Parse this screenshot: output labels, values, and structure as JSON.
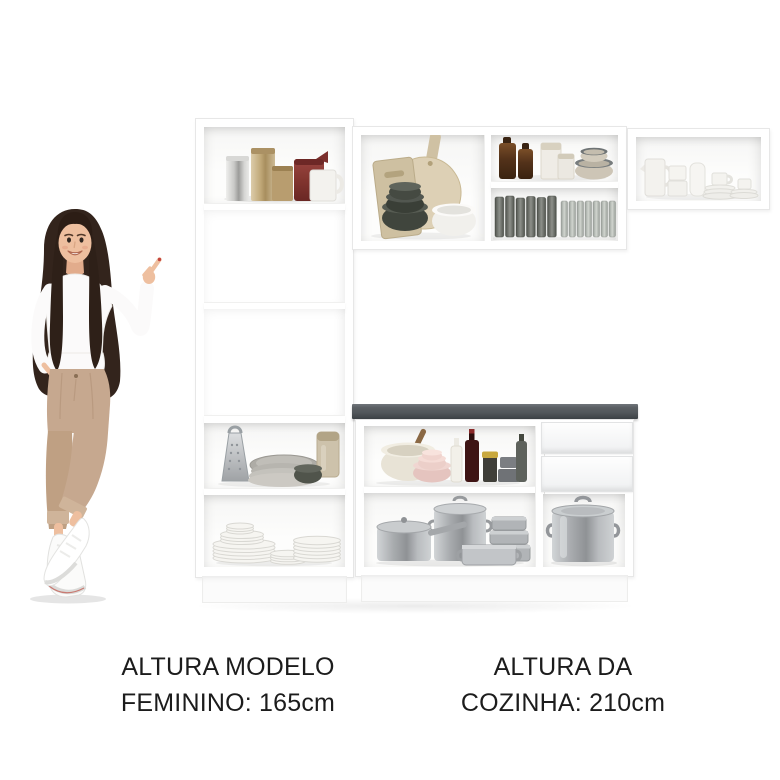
{
  "page": {
    "type": "product-scale-image",
    "background": "#ffffff"
  },
  "captions": {
    "model_height": {
      "line1": "ALTURA MODELO",
      "line2": "FEMININO: 165cm"
    },
    "kitchen_height": {
      "line1": "ALTURA DA",
      "line2": "COZINHA: 210cm"
    }
  },
  "measurements": {
    "model_height": "165cm",
    "kitchen_height": "210cm"
  },
  "model_figure": {
    "description": "woman with long dark hair, white long-sleeve top, beige cropped trousers and white sneakers, pointing up at the kitchen set",
    "pose": "right-hand-pointing-up, left-hand-in-pocket, legs-crossed"
  },
  "kitchen": {
    "tall_cabinet": {
      "compartments": [
        {
          "id": "top-shelf",
          "items": [
            "silver canister",
            "champagne canister",
            "gold tin",
            "dark red jug",
            "white mug"
          ]
        },
        {
          "id": "open-niche-upper",
          "items": []
        },
        {
          "id": "open-niche-lower",
          "items": []
        },
        {
          "id": "middle-shelf",
          "items": [
            "box grater",
            "grey platter stack",
            "storage jar",
            "small dark bowl"
          ]
        },
        {
          "id": "bottom-shelf",
          "items": [
            "pyramid of white plates",
            "small plate stack",
            "plate stack"
          ]
        }
      ]
    },
    "wall_cabinet_middle": {
      "cells": [
        {
          "id": "boards-cell",
          "items": [
            "rectangular cutting board",
            "round cutting board",
            "dark bowl stack",
            "white bowl"
          ]
        },
        {
          "id": "bottles-cell",
          "items": [
            "two amber bottles",
            "two white canisters",
            "beige bowl stack"
          ]
        },
        {
          "id": "glasses-cell",
          "items": [
            "row of dark glasses",
            "row of clear glasses"
          ]
        }
      ]
    },
    "wall_cabinet_right": {
      "cells": [
        {
          "id": "china-cell",
          "items": [
            "white pitcher",
            "white mug stack",
            "white jug",
            "cups and saucers"
          ]
        }
      ]
    },
    "base_cabinet": {
      "countertop": "dark grey",
      "drawers": 2,
      "cells": [
        {
          "id": "prep-shelf",
          "items": [
            "mixing bowl with pestle",
            "pink bowl stack",
            "white bottle",
            "wine bottle",
            "yellow-lid jar",
            "grey canisters",
            "dark bottle"
          ]
        },
        {
          "id": "pots-shelf",
          "items": [
            "saucepan with lid",
            "large lidded pot",
            "stacked pots",
            "low casserole"
          ]
        },
        {
          "id": "stockpot-cell",
          "items": [
            "large stockpot with lid"
          ]
        }
      ]
    }
  },
  "colors": {
    "page_bg": "#ffffff",
    "text": "#1c1c1c",
    "cabinet": "#ffffff",
    "edge": "#e7e7e7",
    "counter_top": "#53585c",
    "hair": "#33241c",
    "hair_dark": "#2c1d15",
    "skin": "#eebf9f",
    "skin_shade": "#e2ac8c",
    "blouse": "#fbfafa",
    "pants": "#c6a88f",
    "pants_dark": "#bfa083",
    "cuff": "#cfb49a",
    "shoe": "#fbfbfa",
    "nail": "#c4453e",
    "china": "#f3f2ee",
    "beige_bowl": "#cdc5b6",
    "wine": "#3e1414",
    "yellow_lid": "#c8a83e",
    "red_canister": "#8c3a38",
    "steel": "#b6b9bc"
  }
}
